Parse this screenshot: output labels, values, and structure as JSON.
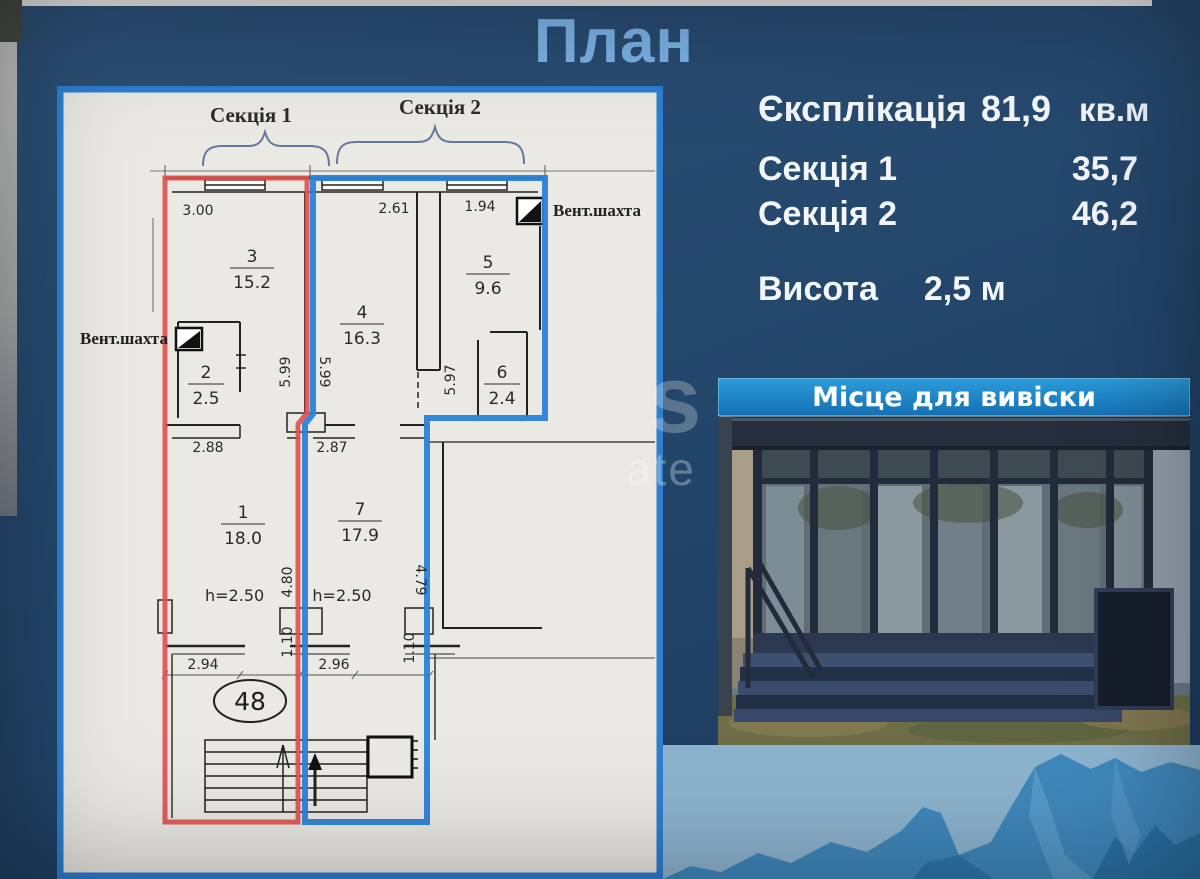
{
  "slide": {
    "title": "План"
  },
  "summary": {
    "explication_label": "Єксплікація",
    "explication_value": "81,9",
    "explication_unit": "кв.м",
    "rows": [
      {
        "label": "Секція 1",
        "value": "35,7"
      },
      {
        "label": "Секція 2",
        "value": "46,2"
      }
    ],
    "height_label": "Висота",
    "height_value": "2,5 м"
  },
  "plan": {
    "section1_label": "Секція 1",
    "section2_label": "Секція 2",
    "vent_left": "Вент.шахта",
    "vent_right": "Вент.шахта",
    "unit_number": "48",
    "rooms": [
      {
        "number": "3",
        "area": "15.2"
      },
      {
        "number": "4",
        "area": "16.3"
      },
      {
        "number": "5",
        "area": "9.6"
      },
      {
        "number": "2",
        "area": "2.5"
      },
      {
        "number": "6",
        "area": "2.4"
      },
      {
        "number": "1",
        "area": "18.0"
      },
      {
        "number": "7",
        "area": "17.9"
      }
    ],
    "dims": {
      "d300": "3.00",
      "d261": "2.61",
      "d194": "1.94",
      "d599a": "5.99",
      "d599b": "5.99",
      "d597": "5.97",
      "d288": "2.88",
      "d287": "2.87",
      "d480": "4.80",
      "d479": "4.79",
      "d110a": "1.10",
      "d110b": "1.10",
      "h1": "h=2.50",
      "h2": "h=2.50",
      "d294": "2.94",
      "d296": "2.96"
    },
    "colors": {
      "section1_outline": "#e0524e",
      "section2_outline": "#2b82d9",
      "frame": "#2e7fd0"
    }
  },
  "photo": {
    "banner": "Місце для вивіски",
    "banner_color": "#2196d6"
  },
  "watermark": {
    "big": "s",
    "small": "ate"
  }
}
